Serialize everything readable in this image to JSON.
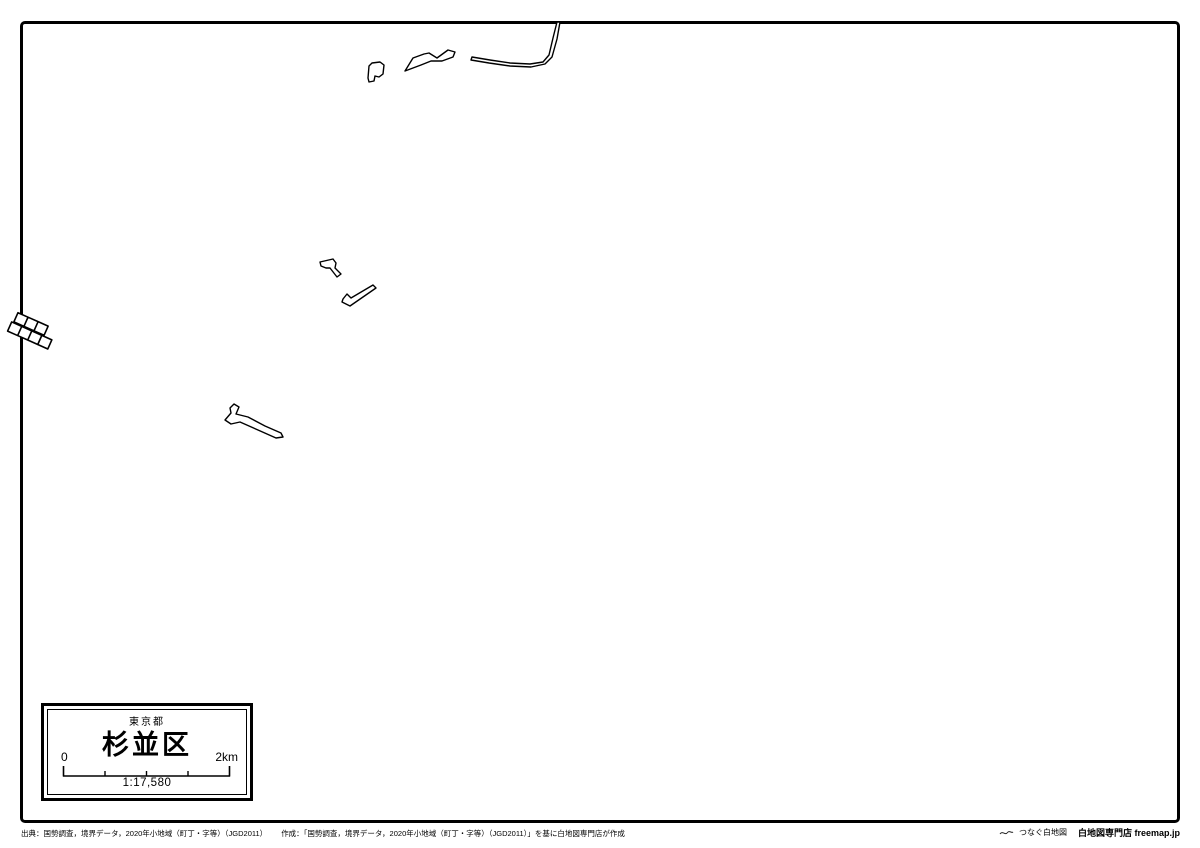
{
  "title_card": {
    "prefecture": "東京都",
    "ward": "杉並区",
    "scale_start": "0",
    "scale_end": "2km",
    "scale_ratio": "1:17,580"
  },
  "footer": {
    "source": "出典：国勢調査，境界データ，2020年小地域（町丁・字等）（JGD2011）",
    "created": "作成：「国勢調査，境界データ，2020年小地域（町丁・字等）（JGD2011）」を基に白地図専門店が作成",
    "tagline": "つなぐ白地図",
    "brand": "白地図専門店 freemap.jp"
  },
  "colors": {
    "outline": "#000000",
    "background": "#ffffff",
    "text": "#000000"
  },
  "shapes": {
    "blob": "M372,63 L380,62 L384,65 L383,74 L379,77 L375,76 L374,81 L369,82 L368,78 L369,66 Z",
    "wave": "M405,71 L413,58 L424,54 L429,53 L437,58 L448,50 L455,52 L453,57 L442,61 L431,61 L421,65 Z",
    "river": "M472,57 L490,60 L510,63 L530,64 L543,62 L549,55 L553,38 L557,22 L560,22 L557,39 L552,57 L545,64 L531,67 L510,66 L489,63 L471,60 Z",
    "zigzag": "M320,262 L333,259 L336,263 L335,268 L341,274 L337,277 L330,268 L326,268 L321,266 Z",
    "checkmark": "M343,299 L347,294 L351,298 L373,285 L376,288 L350,306 L342,302 Z",
    "branch": "M225,420 L231,413 L230,408 L234,404 L239,407 L236,414 L248,417 L265,426 L281,433 L283,437 L276,438 L258,430 L240,422 L231,424 Z",
    "grid": "M16,314 h11 v10 h-11 Z M27,314 h11 v10 h-11 Z M38,314 h11 v10 h-11 Z M14,325 h11 v10 h-11 Z M25,325 h11 v10 h-11 Z M36,325 h11 v10 h-11 Z M47,325 h11 v10 h-11 Z"
  }
}
